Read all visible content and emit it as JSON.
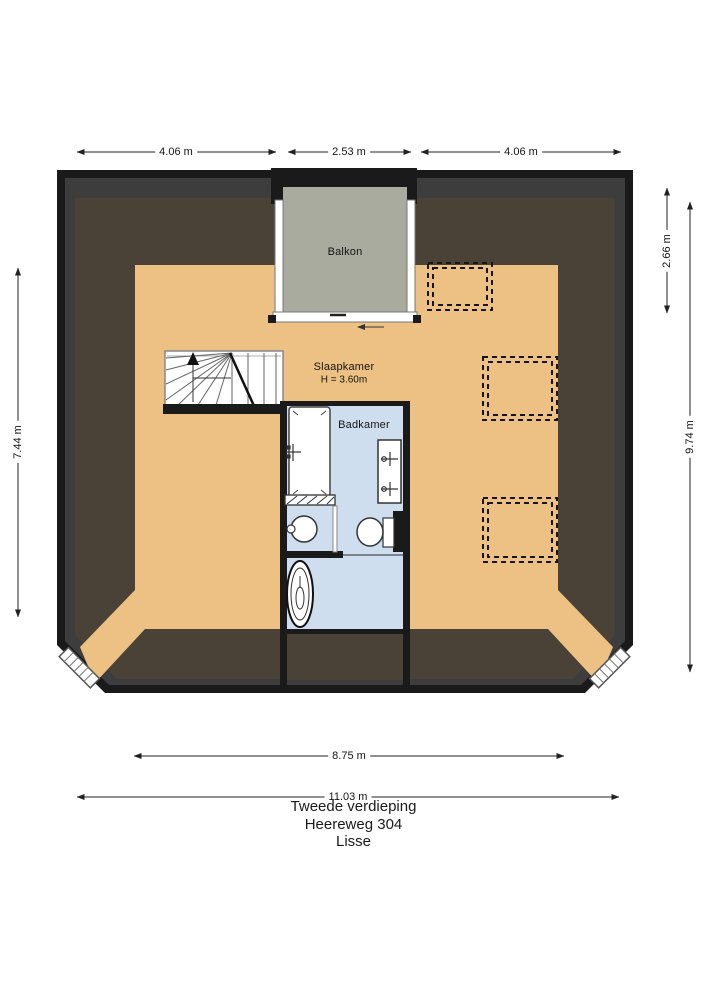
{
  "title": {
    "lines": [
      "Tweede verdieping",
      "Heereweg 304",
      "Lisse"
    ]
  },
  "rooms": {
    "balcony": {
      "label": "Balkon"
    },
    "bedroom": {
      "label": "Slaapkamer",
      "height": "H = 3.60m"
    },
    "bathroom": {
      "label": "Badkamer"
    }
  },
  "dimensions": {
    "top": [
      "4.06 m",
      "2.53 m",
      "4.06 m"
    ],
    "right_balcony_depth": "2.66 m",
    "right_total": "9.74 m",
    "left_height": "7.44 m",
    "bottom_inner": "8.75 m",
    "bottom_total": "11.03 m"
  },
  "colors": {
    "wall": "#1a1a1a",
    "wall_inset": "#3d3d3d",
    "roof_slope": "#4a4237",
    "floor": "#ecc183",
    "balcony_floor": "#a9ab9e",
    "bathroom_floor": "#cfdeef"
  }
}
